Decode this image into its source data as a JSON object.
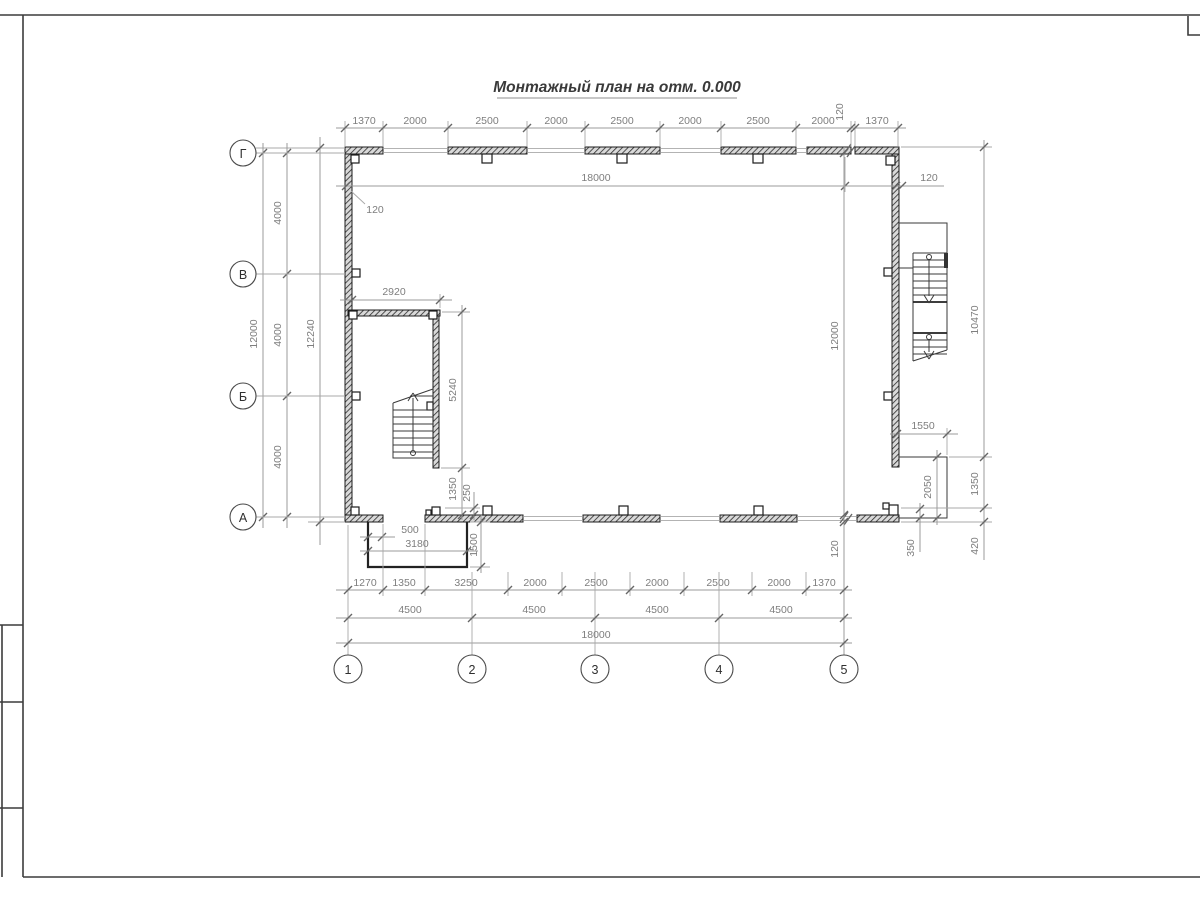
{
  "title": "Монтажный план на отм. 0.000",
  "axes": {
    "rows": [
      "Г",
      "В",
      "Б",
      "А"
    ],
    "cols": [
      "1",
      "2",
      "3",
      "4",
      "5"
    ]
  },
  "dims": {
    "top": {
      "segments": [
        "1370",
        "2000",
        "2500",
        "2000",
        "2500",
        "2000",
        "2500",
        "2000"
      ],
      "offset": "120",
      "end_panel": "1370",
      "overall": "18000",
      "wall_left": "120",
      "wall_right": "120"
    },
    "left": {
      "overall": "12000",
      "bays": [
        "4000",
        "4000",
        "4000"
      ],
      "outer": "12240"
    },
    "stairwell": {
      "width": "2920",
      "length": "5240",
      "to_wall": "1350",
      "offset": "250",
      "door": "500",
      "porch_width": "3180",
      "porch_depth": "1500"
    },
    "right": {
      "overall": "12000",
      "wall": "120",
      "outer": "10470",
      "landing_width": "1550",
      "landing_depth": "2050",
      "lower": "1350",
      "step": "350",
      "base": "420"
    },
    "bottom": {
      "segments": [
        "1270",
        "1350",
        "3250",
        "2000",
        "2500",
        "2000",
        "2500",
        "2000",
        "1370"
      ],
      "bays": [
        "4500",
        "4500",
        "4500",
        "4500"
      ],
      "overall": "18000"
    }
  }
}
